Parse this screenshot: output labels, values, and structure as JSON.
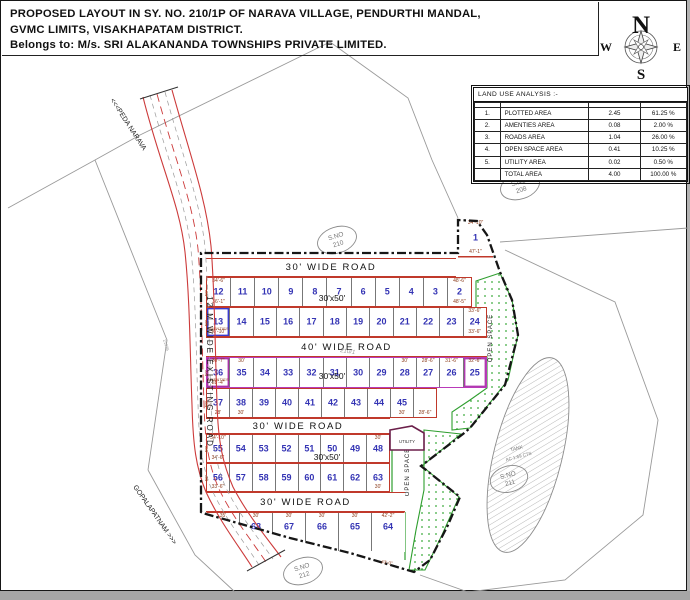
{
  "title": {
    "line1": "PROPOSED LAYOUT IN SY. NO. 210/1P OF NARAVA VILLAGE, PENDURTHI MANDAL,",
    "line2": "GVMC LIMITS, VISAKHAPATAM DISTRICT.",
    "line3": "Belongs to: M/s. SRI ALAKANANDA TOWNSHIPS PRIVATE LIMITED."
  },
  "compass": {
    "n": "N",
    "s": "S",
    "e": "E",
    "w": "W"
  },
  "land_use_table": {
    "title": "LAND USE ANALYSIS :-",
    "headers": [
      "SL.NO.",
      "DESCRIPTION",
      "EXTENT IN\nAcs.-cts.",
      "PERCENTAGE"
    ],
    "rows": [
      [
        "1.",
        "PLOTTED  AREA",
        "2.45",
        "61.25 %"
      ],
      [
        "2.",
        "AMENTIES  AREA",
        "0.08",
        "2.00 %"
      ],
      [
        "3.",
        "ROADS  AREA",
        "1.04",
        "26.00 %"
      ],
      [
        "4.",
        "OPEN SPACE AREA",
        "0.41",
        "10.25 %"
      ],
      [
        "5.",
        "UTILITY  AREA",
        "0.02",
        "0.50 %"
      ],
      [
        "",
        "TOTAL  AREA",
        "4.00",
        "100.00 %"
      ]
    ]
  },
  "roads": {
    "band1": "30' WIDE ROAD",
    "band2": "40' WIDE ROAD",
    "band3": "30' WIDE ROAD",
    "band4": "30' WIDE ROAD",
    "existing": "12 M  WIDE  EXISTING  ROAD",
    "to_north": "<<<PEDA NARAVA",
    "to_south": "GOPALAPATNAM >>>"
  },
  "plot_size_labels": [
    "30'x50'",
    "30'x50'",
    "30'x50'"
  ],
  "survey_labels": {
    "s208": {
      "label": "S.NO",
      "num": "208"
    },
    "s210": {
      "label": "S.NO",
      "num": "210"
    },
    "s211": {
      "label": "S.NO",
      "num": "211"
    },
    "s212": {
      "label": "S.NO",
      "num": "212"
    }
  },
  "tank": {
    "line1": "TANK",
    "line2": "AC 1.69 CTS"
  },
  "open_space_label": "OPEN SPACE",
  "utility_label": "UTILITY",
  "annotations": {
    "a1": "210/1",
    "a2": "21936",
    "a3": "210/2",
    "a4": "43'-0\""
  },
  "plot1": {
    "n": "1",
    "top": "34'-10\"",
    "bottom": "47'-1\""
  },
  "plots": {
    "rowA1": [
      {
        "n": "12",
        "top": "34'-6\"",
        "bottom": "36'-1\"",
        "left": "50'"
      },
      {
        "n": "11"
      },
      {
        "n": "10"
      },
      {
        "n": "9"
      },
      {
        "n": "8"
      },
      {
        "n": "7"
      },
      {
        "n": "6"
      },
      {
        "n": "5"
      },
      {
        "n": "4"
      },
      {
        "n": "3"
      },
      {
        "n": "2",
        "top": "48'-6\"",
        "bottom": "48'-5\""
      }
    ],
    "rowA2": [
      {
        "n": "13",
        "cls": "amenity-blue",
        "tag": "AMENTIES",
        "bottom": "36'-10\"",
        "left": "50'"
      },
      {
        "n": "14"
      },
      {
        "n": "15"
      },
      {
        "n": "16"
      },
      {
        "n": "17"
      },
      {
        "n": "18"
      },
      {
        "n": "19"
      },
      {
        "n": "20"
      },
      {
        "n": "21"
      },
      {
        "n": "22"
      },
      {
        "n": "23"
      },
      {
        "n": "24",
        "top": "33'-6\"",
        "bottom": "33'-6\""
      }
    ],
    "rowB1": [
      {
        "n": "36",
        "cls": "amenity-purple",
        "top": "30'-7\"",
        "tag": "AMENTIES",
        "bottom": "28'-4\"",
        "left": "50'"
      },
      {
        "n": "35",
        "top": "30'"
      },
      {
        "n": "34"
      },
      {
        "n": "33"
      },
      {
        "n": "32"
      },
      {
        "n": "31"
      },
      {
        "n": "30"
      },
      {
        "n": "29"
      },
      {
        "n": "28",
        "top": "30'"
      },
      {
        "n": "27",
        "top": "28'-6\""
      },
      {
        "n": "26",
        "top": "31'-6\""
      },
      {
        "n": "25",
        "cls": "pent",
        "top": "32'-6\""
      }
    ],
    "rowB2": [
      {
        "n": "37",
        "bottom": "28'",
        "left": "50'"
      },
      {
        "n": "38",
        "bottom": "30'"
      },
      {
        "n": "39"
      },
      {
        "n": "40"
      },
      {
        "n": "41"
      },
      {
        "n": "42"
      },
      {
        "n": "43"
      },
      {
        "n": "44"
      },
      {
        "n": "45",
        "bottom": "30'"
      },
      {
        "n": "",
        "bottom": "28'-6\""
      }
    ],
    "rowC1": [
      {
        "n": "55",
        "top": "34'-10\"",
        "bottom": "34'-6\"",
        "left": "50'"
      },
      {
        "n": "54"
      },
      {
        "n": "53"
      },
      {
        "n": "52"
      },
      {
        "n": "51"
      },
      {
        "n": "50"
      },
      {
        "n": "49"
      },
      {
        "n": "48",
        "top": "30'"
      }
    ],
    "rowC2": [
      {
        "n": "56",
        "bottom": "33'-6\"",
        "left": "50'"
      },
      {
        "n": "57"
      },
      {
        "n": "58"
      },
      {
        "n": "59"
      },
      {
        "n": "60"
      },
      {
        "n": "61"
      },
      {
        "n": "62"
      },
      {
        "n": "63",
        "bottom": "30'"
      }
    ],
    "rowD": [
      {
        "n": "69",
        "top": "35'"
      },
      {
        "n": "68",
        "top": "30'"
      },
      {
        "n": "67",
        "top": "30'"
      },
      {
        "n": "66",
        "top": "30'"
      },
      {
        "n": "65",
        "top": "30'"
      },
      {
        "n": "64",
        "top": "42'-2\""
      }
    ]
  }
}
